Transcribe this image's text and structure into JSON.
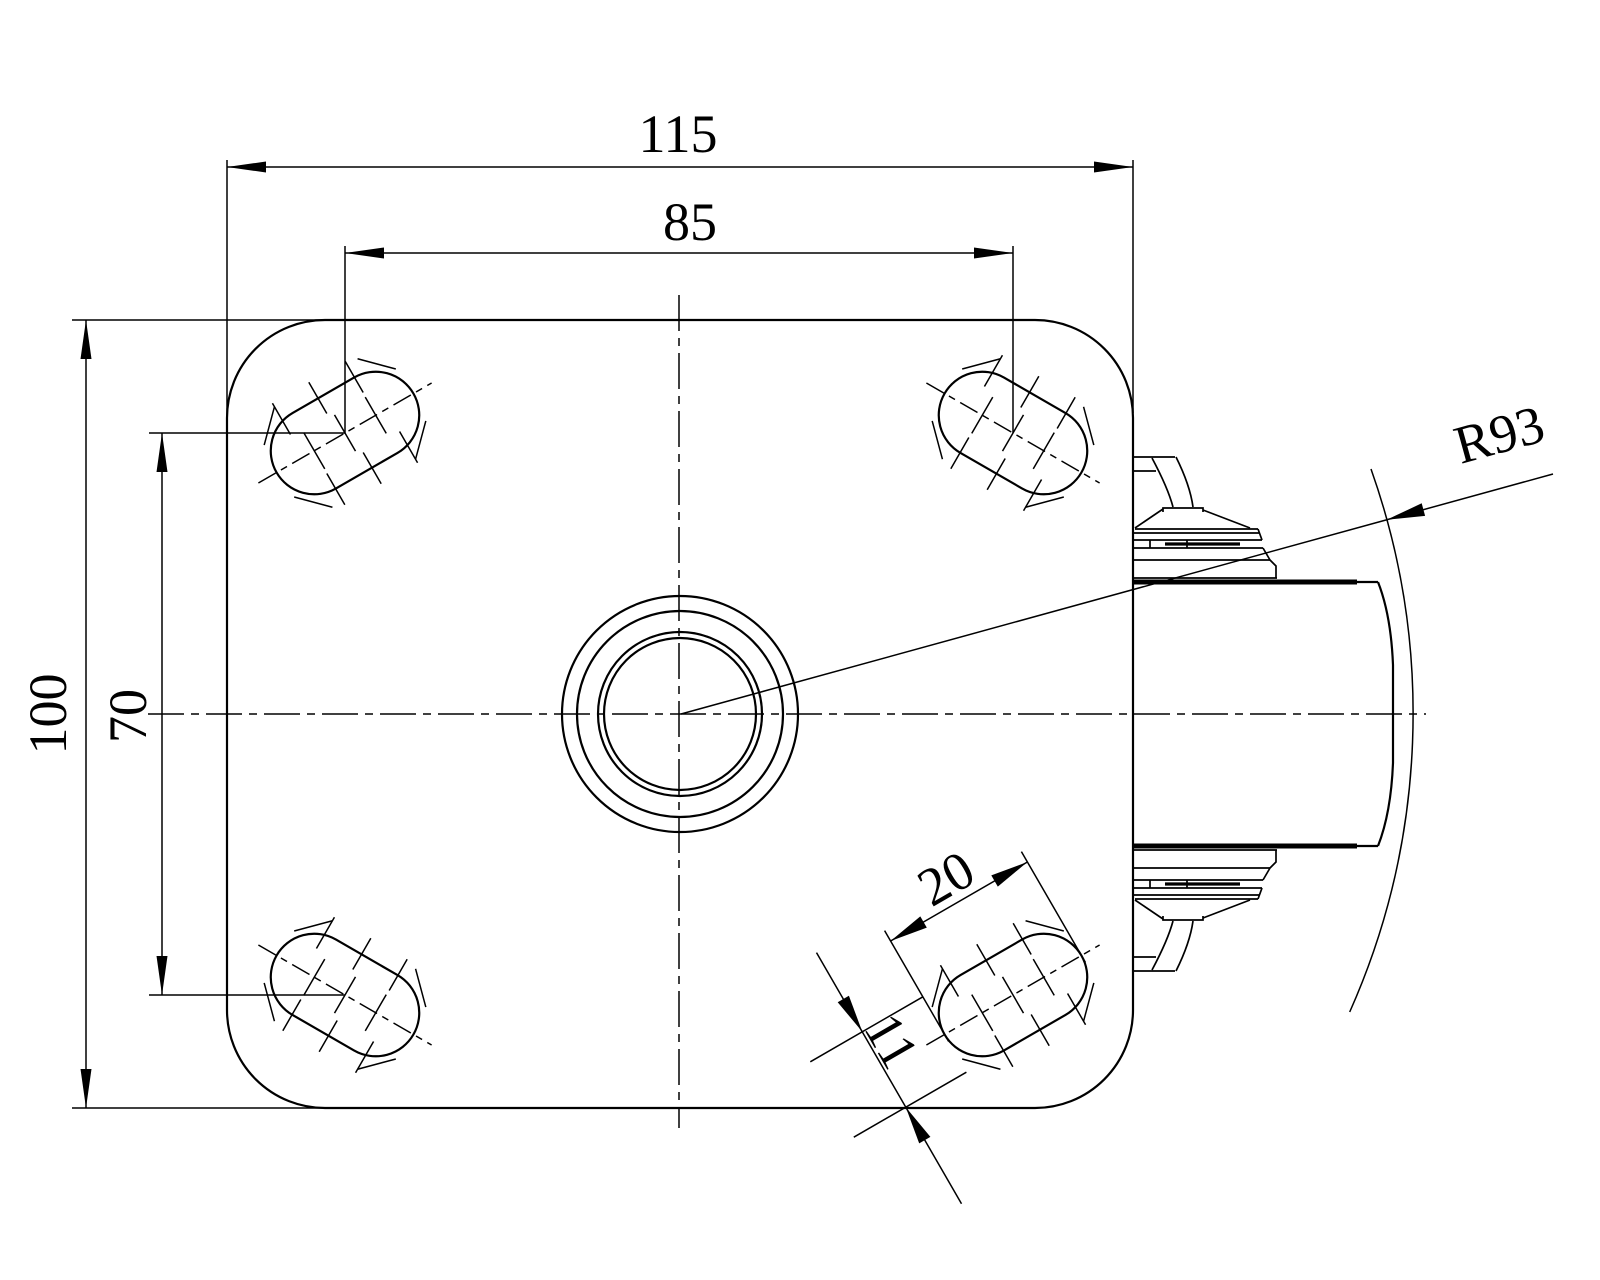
{
  "drawing": {
    "type": "caster-mounting-plate-technical-drawing",
    "background_color": "#ffffff",
    "line_color": "#000000",
    "labels": {
      "plate_width": "115",
      "hole_spacing_width": "85",
      "plate_height": "100",
      "hole_spacing_height": "70",
      "slot_length": "20",
      "slot_width": "11",
      "swivel_radius": "R93"
    }
  }
}
